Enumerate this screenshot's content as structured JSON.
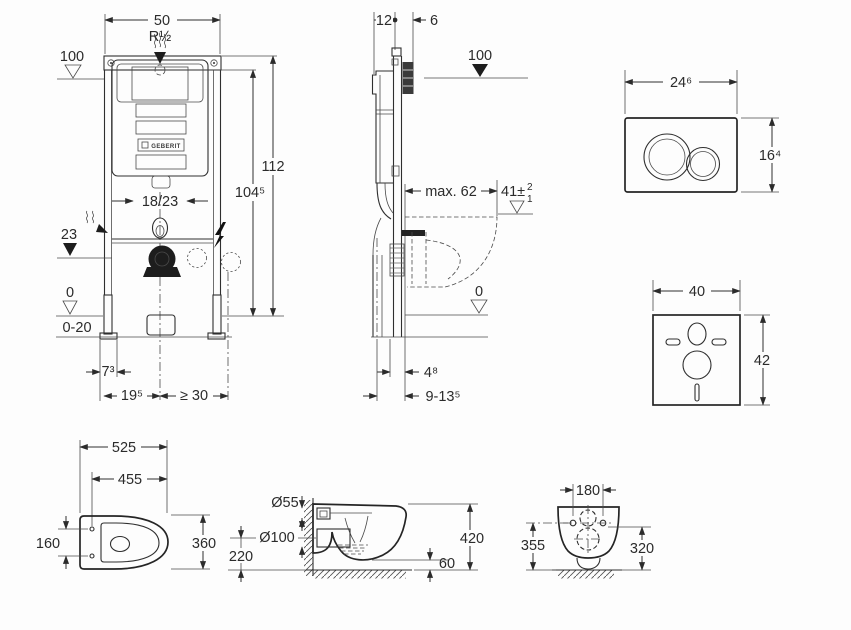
{
  "frame_front": {
    "width": "50",
    "thread": "R½",
    "supply_level": "100",
    "height": "112",
    "supply_height": "104⁵",
    "outlet_offset": "18/23",
    "drain_level": "23",
    "zero_level": "0",
    "floor_range": "0-20",
    "foot_offset": "7³",
    "drain_offset": "19⁵",
    "clearance": "≥ 30",
    "logo": "GEBERIT"
  },
  "frame_side": {
    "depth": "12",
    "plate_depth": "6",
    "supply_level": "100",
    "max_offset": "max. 62",
    "bowl_height": "41±",
    "bowl_tol_plus": "2",
    "bowl_tol_minus": "1",
    "zero_level": "0",
    "wall_offset": "4⁸",
    "pipe_offset": "9-13⁵"
  },
  "flush_plate": {
    "width": "24⁶",
    "height": "16⁴"
  },
  "sound_mat": {
    "width": "40",
    "height": "42"
  },
  "wc_top": {
    "length": "525",
    "inner_length": "455",
    "hole_spacing": "160",
    "width": "360"
  },
  "wc_side": {
    "inlet": "Ø55",
    "outlet": "Ø100",
    "outlet_height": "220",
    "height": "420",
    "bottom_gap": "60"
  },
  "wc_front": {
    "hole_spacing": "180",
    "height_left": "355",
    "height_right": "320"
  }
}
